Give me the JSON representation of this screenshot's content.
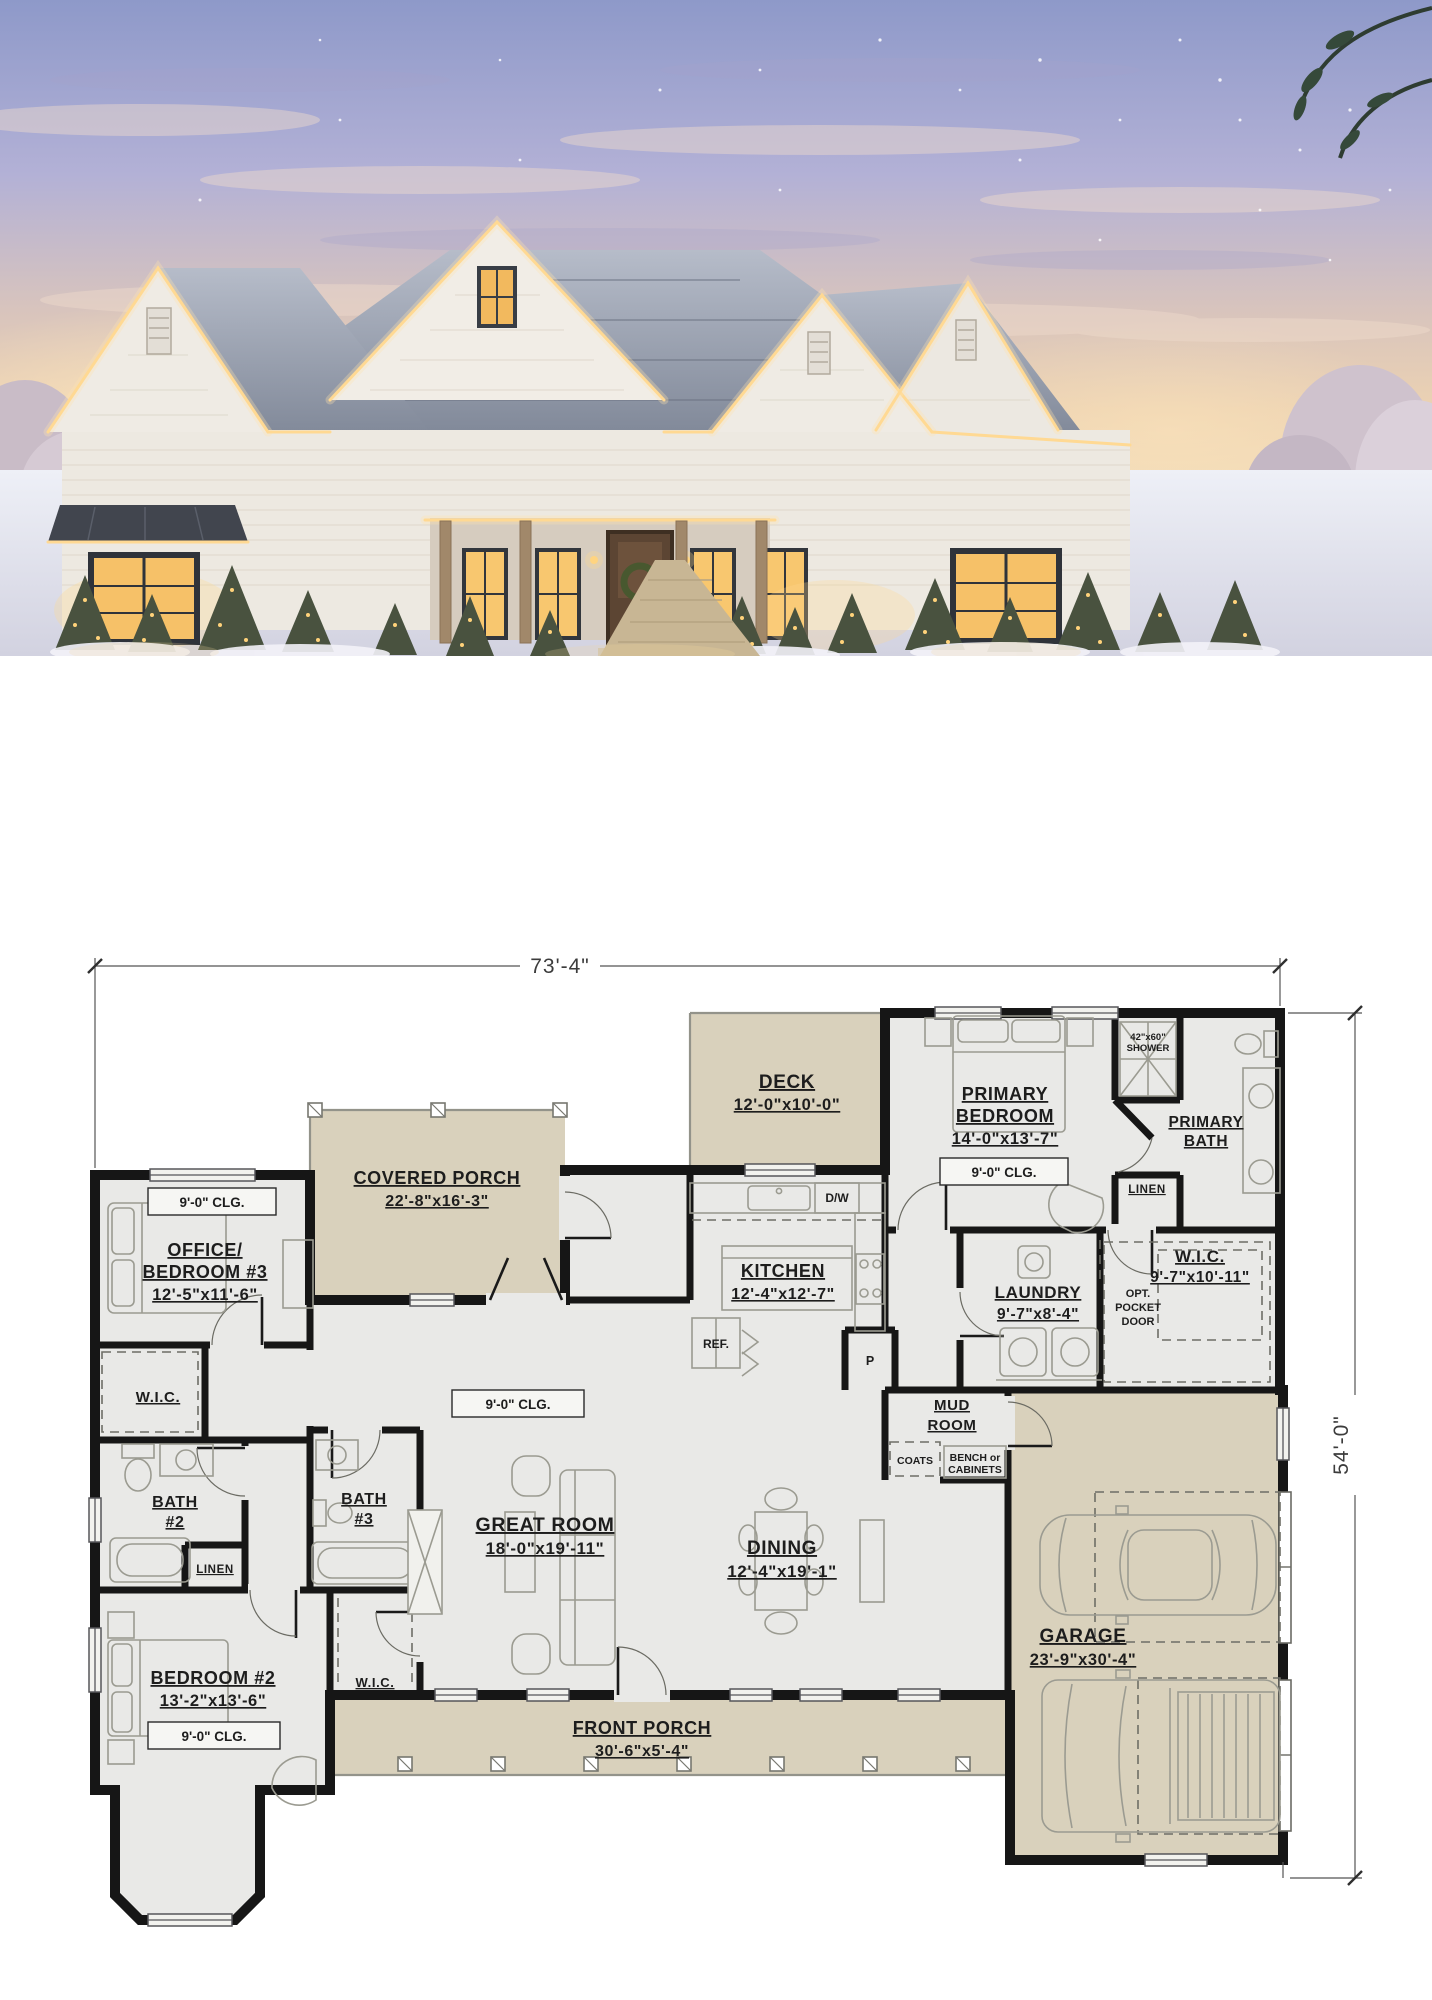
{
  "plan": {
    "dimensions": {
      "width": "73'-4\"",
      "height": "54'-0\""
    },
    "labels": {
      "deck": {
        "name": "DECK",
        "dims": "12'-0\"x10'-0\""
      },
      "covered_porch": {
        "name": "COVERED PORCH",
        "dims": "22'-8\"x16'-3\""
      },
      "office": {
        "name1": "OFFICE/",
        "name2": "BEDROOM #3",
        "dims": "12'-5\"x11'-6\"",
        "clg": "9'-0\" CLG."
      },
      "wic_left": {
        "name": "W.I.C."
      },
      "bath2": {
        "name1": "BATH",
        "name2": "#2"
      },
      "linen_left": {
        "name": "LINEN"
      },
      "bath3": {
        "name1": "BATH",
        "name2": "#3"
      },
      "bedroom2": {
        "name": "BEDROOM #2",
        "dims": "13'-2\"x13'-6\"",
        "clg": "9'-0\" CLG."
      },
      "wic_bedroom2": {
        "name": "W.I.C."
      },
      "great_room": {
        "name": "GREAT ROOM",
        "dims": "18'-0\"x19'-11\"",
        "clg": "9'-0\" CLG."
      },
      "kitchen": {
        "name": "KITCHEN",
        "dims": "12'-4\"x12'-7\"",
        "ref": "REF.",
        "dw": "D/W",
        "pantry": "P"
      },
      "dining": {
        "name": "DINING",
        "dims": "12'-4\"x19'-1\""
      },
      "primary_bedroom": {
        "name1": "PRIMARY",
        "name2": "BEDROOM",
        "dims": "14'-0\"x13'-7\"",
        "clg": "9'-0\" CLG."
      },
      "primary_bath": {
        "name1": "PRIMARY",
        "name2": "BATH"
      },
      "shower": {
        "line1": "42\"x60\"",
        "line2": "SHOWER"
      },
      "linen_primary": {
        "name": "LINEN"
      },
      "wic_primary": {
        "name": "W.I.C.",
        "dims": "9'-7\"x10'-11\""
      },
      "pocket_door": {
        "line1": "OPT.",
        "line2": "POCKET",
        "line3": "DOOR"
      },
      "laundry": {
        "name": "LAUND RY",
        "dims": "9'-7\"x8'-4\""
      },
      "mud_room": {
        "line1": "MUD",
        "line2": "ROOM"
      },
      "coats": {
        "name": "COATS"
      },
      "bench": {
        "line1": "BENCH or",
        "line2": "CABINETS"
      },
      "front_porch": {
        "name": "FRONT PORCH",
        "dims": "30'-6\"x5'-4\""
      },
      "garage": {
        "name": "GARAGE",
        "dims": "23'-9\"x30'-4\""
      }
    },
    "colors": {
      "wall": "#161616",
      "room_fill": "#e9e9e7",
      "porch_fill": "#d9d1bc"
    }
  }
}
